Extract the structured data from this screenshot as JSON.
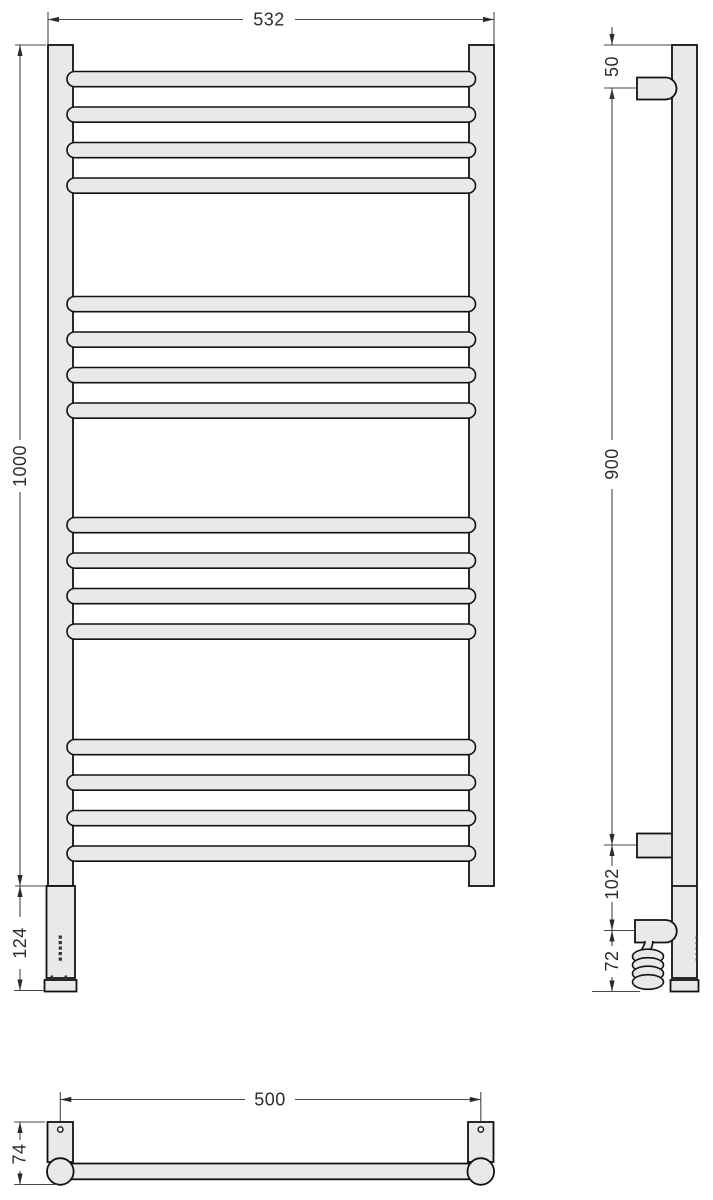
{
  "front_view": {
    "width": "532",
    "height": "1000",
    "bottom_section_height": "124"
  },
  "side_view": {
    "top_to_bracket": "50",
    "bracket_spacing": "900",
    "bracket_to_outlet": "102",
    "outlet_to_bottom": "72"
  },
  "plan_view": {
    "mount_spacing": "500",
    "depth": "74"
  }
}
